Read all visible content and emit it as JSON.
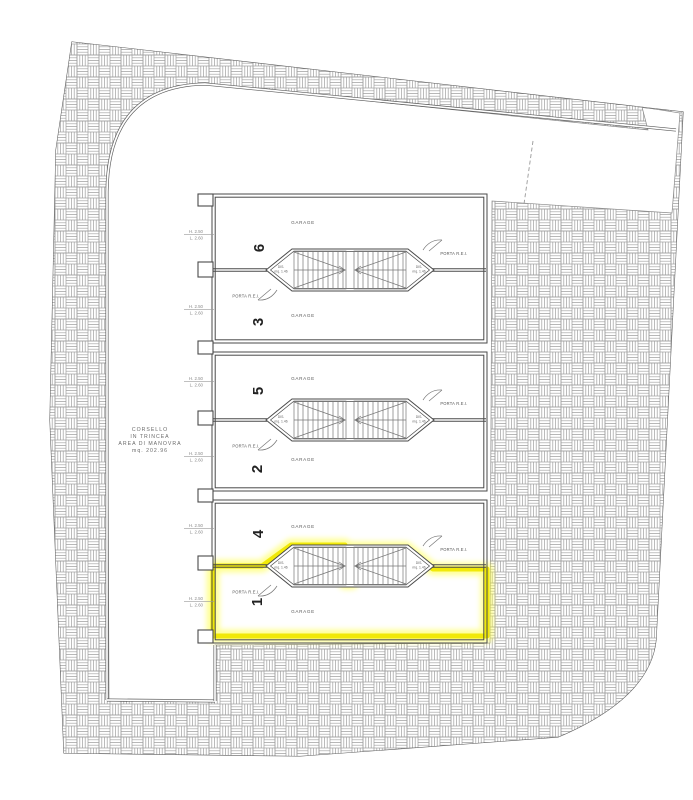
{
  "drawing_type": "garage-level floor plan",
  "corsello": {
    "l1": "CORSELLO",
    "l2": "IN TRINCEA",
    "l3": "AREA DI MANOVRA",
    "l4": "mq. 202.96"
  },
  "door_label": {
    "h": "H. 2.50",
    "l": "L. 2.60"
  },
  "stair": {
    "dis1": "DIS.",
    "dis2": "mq. 1.46",
    "porta": "PORTA R.E.I."
  },
  "units": [
    {
      "number": "6",
      "room": "GARAGE"
    },
    {
      "number": "3",
      "room": "GARAGE"
    },
    {
      "number": "5",
      "room": "GARAGE"
    },
    {
      "number": "2",
      "room": "GARAGE"
    },
    {
      "number": "4",
      "room": "GARAGE"
    },
    {
      "number": "1",
      "room": "GARAGE"
    }
  ],
  "highlight": {
    "unit": "1",
    "color": "#f0e800",
    "glow": "#ffff3d"
  }
}
